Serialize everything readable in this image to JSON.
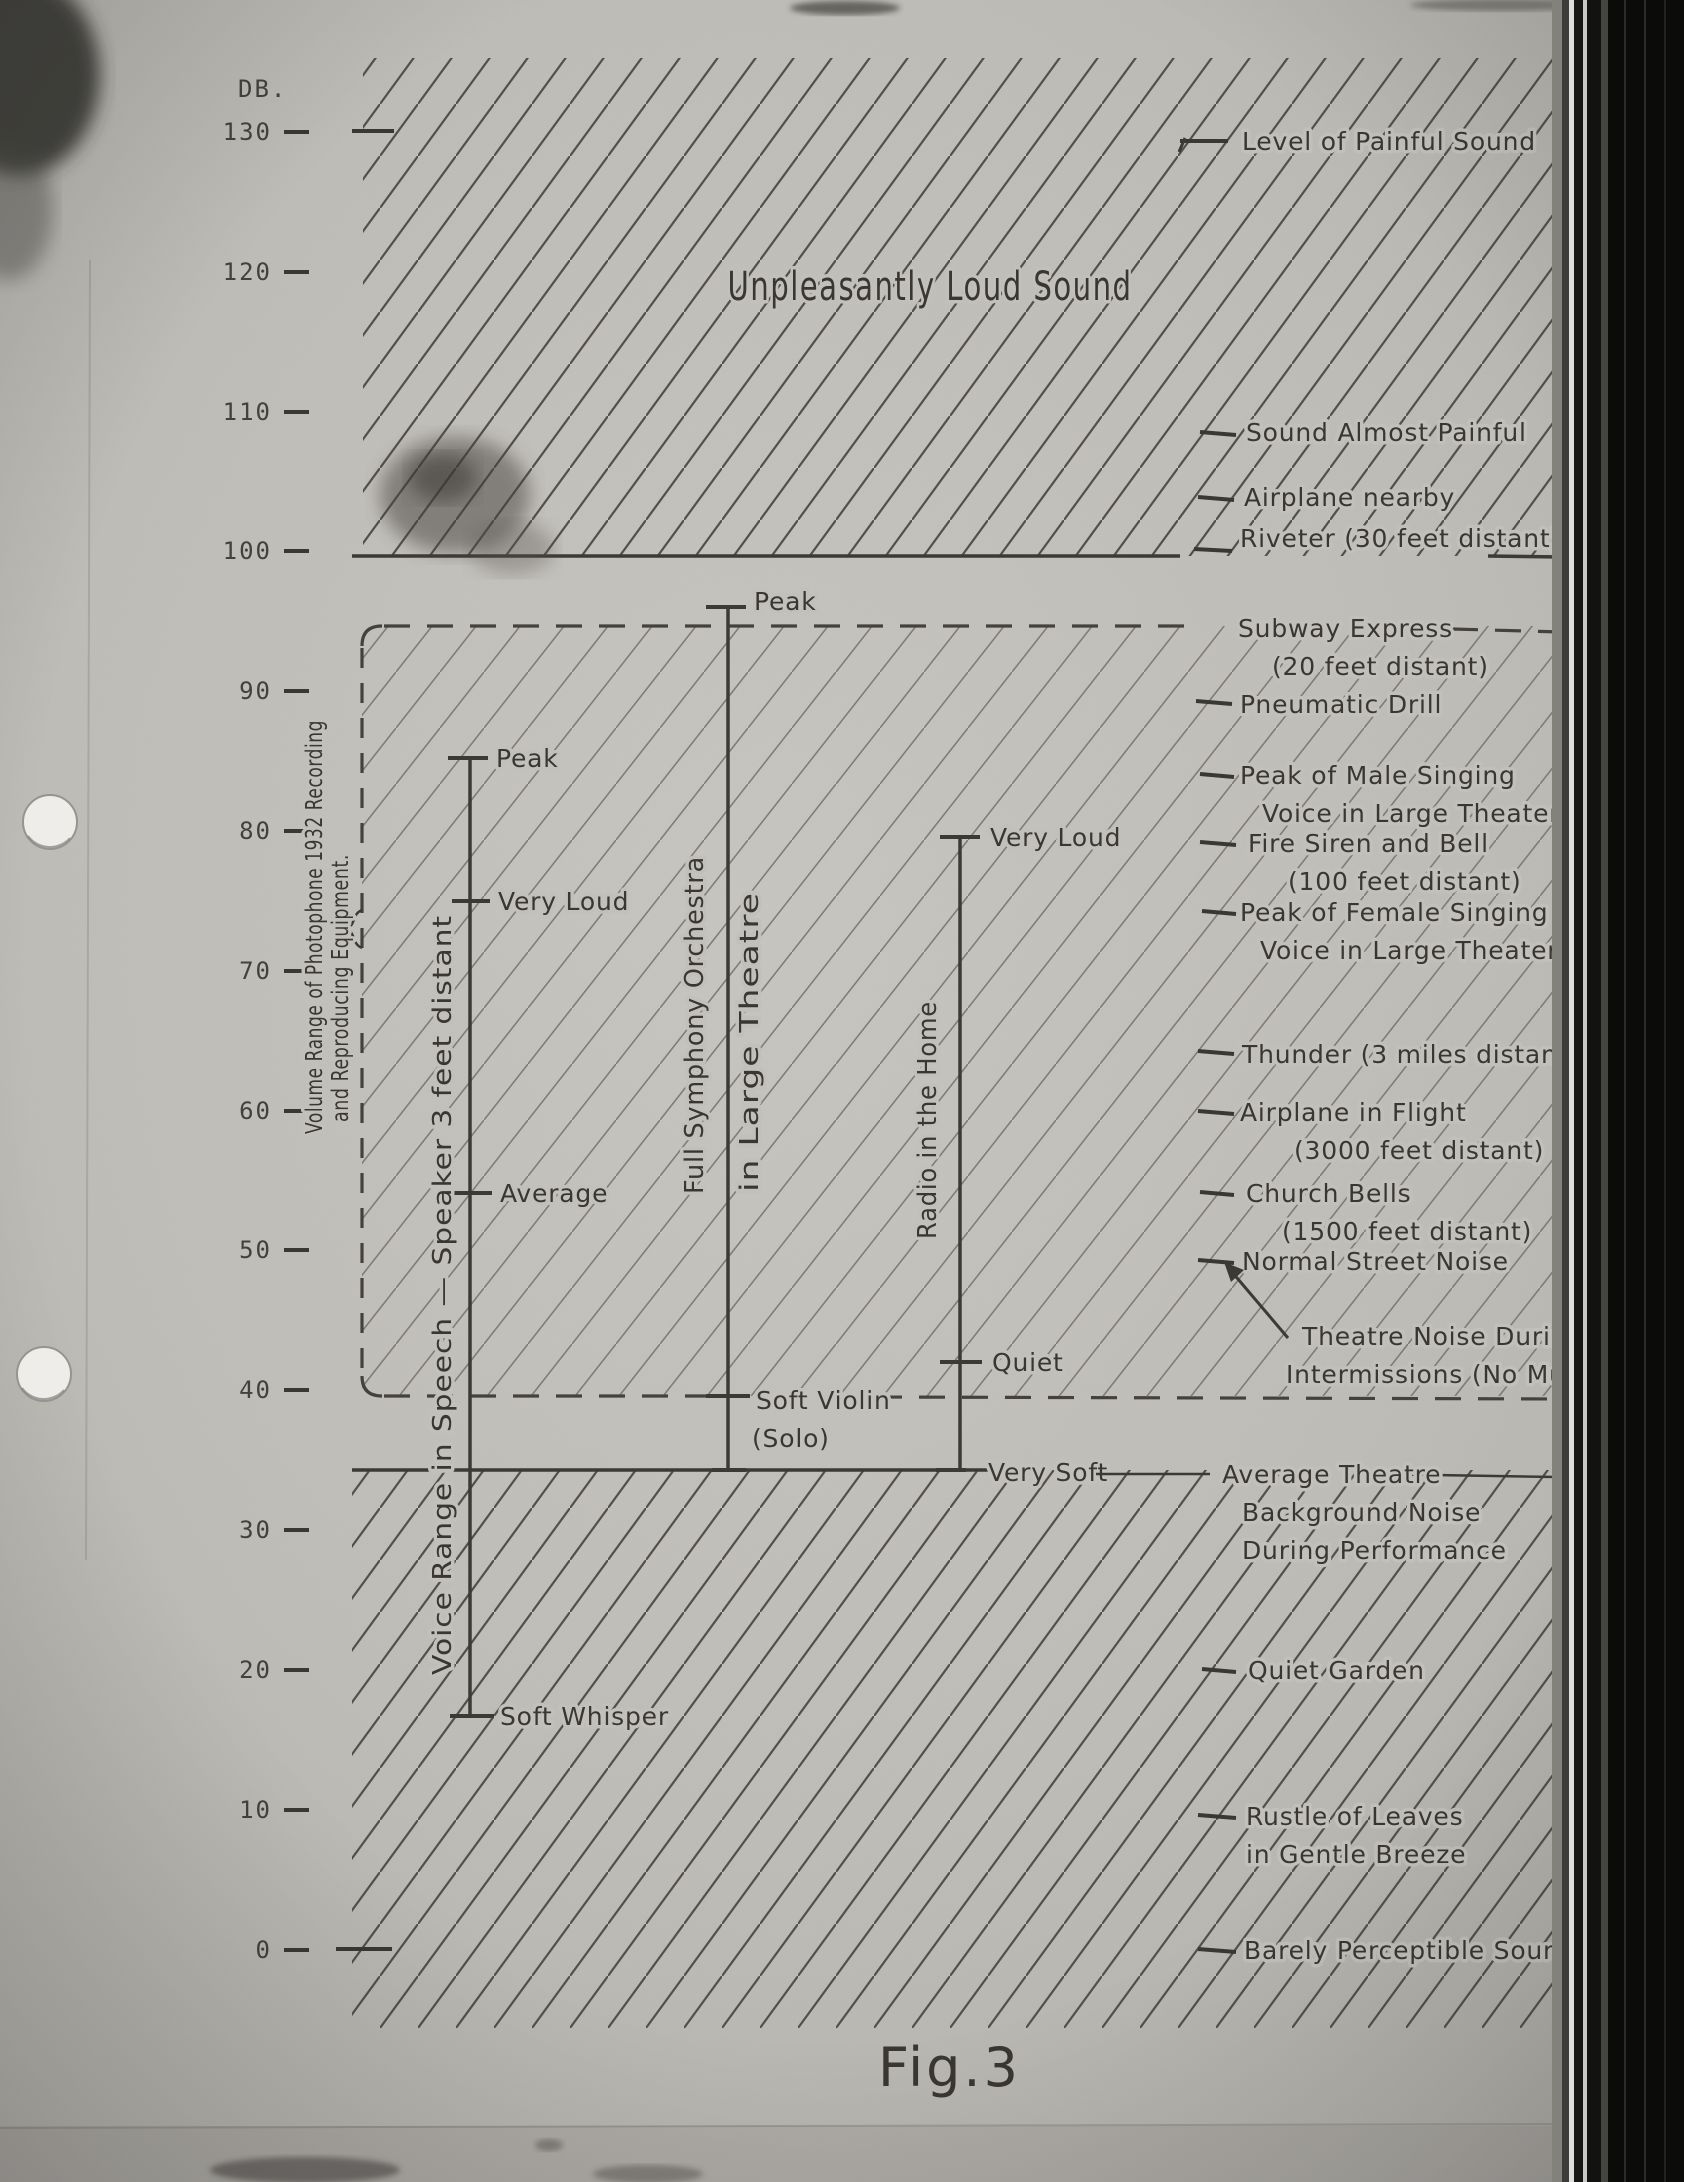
{
  "chart_data": {
    "type": "scatter",
    "title": "Fig.3",
    "ylabel": "DB.",
    "ylim": [
      0,
      130
    ],
    "yticks": [
      130,
      120,
      110,
      100,
      90,
      80,
      70,
      60,
      50,
      40,
      30,
      20,
      10,
      0
    ],
    "grid": false,
    "legend_position": "none",
    "annotations": {
      "loud_region": {
        "label": "Unpleasantly Loud Sound",
        "from_db": 100,
        "to_db": 132
      },
      "equipment_range": {
        "label_lines": [
          "Volume Range of Photophone 1932 Recording",
          "and Reproducing Equipment."
        ],
        "from_db": 40,
        "to_db": 95
      }
    },
    "sound_levels": [
      {
        "db": 130,
        "lines": [
          "Level of Painful Sound"
        ]
      },
      {
        "db": 108,
        "lines": [
          "Sound Almost Painful"
        ]
      },
      {
        "db": 104,
        "lines": [
          "Airplane nearby"
        ]
      },
      {
        "db": 100,
        "lines": [
          "Riveter (30 feet distant)"
        ]
      },
      {
        "db": 95,
        "lines": [
          "Subway Express",
          "(20 feet distant)"
        ]
      },
      {
        "db": 90,
        "lines": [
          "Pneumatic Drill"
        ]
      },
      {
        "db": 84,
        "lines": [
          "Peak of Male Singing",
          "Voice in Large Theater"
        ]
      },
      {
        "db": 80,
        "lines": [
          "Fire Siren and Bell",
          "(100 feet distant)"
        ]
      },
      {
        "db": 75,
        "lines": [
          "Peak of Female Singing",
          "Voice in Large Theater"
        ]
      },
      {
        "db": 65,
        "lines": [
          "Thunder (3 miles distant)"
        ]
      },
      {
        "db": 60,
        "lines": [
          "Airplane in Flight",
          "(3000 feet distant)"
        ]
      },
      {
        "db": 55,
        "lines": [
          "Church Bells",
          "(1500 feet distant)"
        ]
      },
      {
        "db": 50,
        "lines": [
          "Normal Street Noise"
        ]
      },
      {
        "db": 48,
        "lines": [
          "Theatre Noise During",
          "Intermissions (No Music)"
        ]
      },
      {
        "db": 35,
        "lines": [
          "Average Theatre",
          "Background Noise",
          "During Performance"
        ]
      },
      {
        "db": 20,
        "lines": [
          "Quiet Garden"
        ]
      },
      {
        "db": 10,
        "lines": [
          "Rustle of Leaves",
          "in Gentle Breeze"
        ]
      },
      {
        "db": 0,
        "lines": [
          "Barely Perceptible Sound"
        ]
      }
    ],
    "ranges": [
      {
        "label": "Voice Range in Speech — Speaker 3 feet distant",
        "marks": [
          {
            "label": "Peak",
            "db": 85
          },
          {
            "label": "Very Loud",
            "db": 75
          },
          {
            "label": "Average",
            "db": 54
          },
          {
            "label": "Soft Whisper",
            "db": 17
          }
        ]
      },
      {
        "label_left": "Full Symphony Orchestra",
        "label_right": "in Large Theatre",
        "bottom_db": 35,
        "marks": [
          {
            "label": "Peak",
            "db": 96
          },
          {
            "label": "Soft Violin",
            "label_line2": "(Solo)",
            "db": 40
          }
        ]
      },
      {
        "label": "Radio in the Home",
        "marks": [
          {
            "label": "Very Loud",
            "db": 80
          },
          {
            "label": "Quiet",
            "db": 42
          },
          {
            "label": "Very Soft",
            "db": 35
          }
        ]
      }
    ]
  }
}
